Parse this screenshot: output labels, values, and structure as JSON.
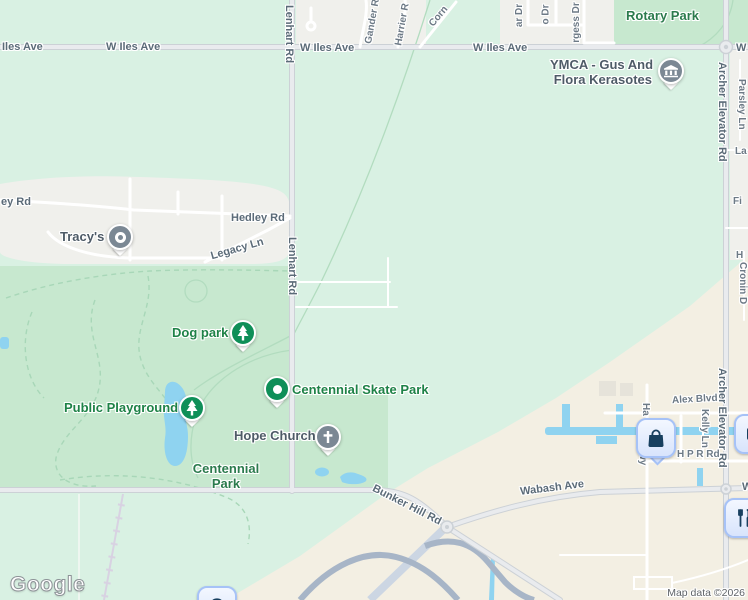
{
  "colors": {
    "mint": "#d9f1e3",
    "park-green": "#c7e8cf",
    "residential": "#f0f0ec",
    "beige": "#f3efe3",
    "water": "#8fd3f0",
    "road-casing": "#ccd1d6",
    "road-fill": "#e9ebee",
    "minor-road": "#ffffff",
    "highway-dark": "#a7b5c7",
    "highway-light": "#ccd6e3",
    "railroad": "#d8d2e2",
    "trail": "#a8d7b8",
    "road-label": "#5b6b78",
    "street-label": "#6d7a86",
    "poi-gray": "#4e5b67",
    "poi-green": "#1e8247",
    "park-label": "#2b7b4d",
    "pin-gray": "#7b8894",
    "pin-green": "#0f8f58",
    "marker-navy": "#173f5f",
    "marker-border": "#a6c2f7",
    "attribution-text": "#5f6368"
  },
  "road_labels": {
    "iles_ave_partial": "Iles Ave",
    "w_iles_ave": "W Iles Ave",
    "w_partial": "W",
    "lenhart_rd": "Lenhart Rd",
    "archer_elevator_rd": "Archer Elevator Rd",
    "hedley_rd": "Hedley Rd",
    "hedley_rd_partial_left": "ey Rd",
    "legacy_ln": "Legacy Ln",
    "bunker_hill_rd": "Bunker Hill Rd",
    "wabash_ave": "Wabash Ave",
    "alex_blvd": "Alex Blvd",
    "kelly_ln": "Kelly Ln",
    "h_p_r_rd": "H P R Rd",
    "parsley_ln": "Parsley Ln",
    "gander_partial": "Gander R",
    "harrier_partial": "Harrier R",
    "corn_partial": "Corn",
    "ar_dr_partial": "ar Dr",
    "o_dr_partial": "o Dr",
    "rgess_dr_partial": "rgess Dr",
    "la_partial": "La",
    "fi_partial": "Fi",
    "h_partial": "H",
    "cronin_partial": "Cronin D",
    "ha_partial": "Ha",
    "wy_partial": "wy"
  },
  "places": {
    "rotary_park": "Rotary Park",
    "ymca_line1": "YMCA - Gus And",
    "ymca_line2": "Flora Kerasotes",
    "tracys": "Tracy's",
    "dog_park": "Dog park",
    "centennial_skate_park": "Centennial Skate Park",
    "public_playground": "Public Playground",
    "hope_church": "Hope Church",
    "centennial_park_line1": "Centennial",
    "centennial_park_line2": "Park"
  },
  "markers": {
    "tracys_icon": "place-dot-icon",
    "ymca_icon": "museum-building-icon",
    "dog_park_icon": "tree-icon",
    "skate_park_icon": "park-dot-icon",
    "playground_icon": "tree-icon",
    "church_icon": "cross-icon",
    "shopping_icon": "shopping-bag-icon",
    "restaurant_icon": "restaurant-icon",
    "partial_right_icon": "place-icon",
    "partial_bottom_icon": "circle-icon"
  },
  "footer": {
    "logo": "Google",
    "attribution": "Map data ©2026"
  }
}
